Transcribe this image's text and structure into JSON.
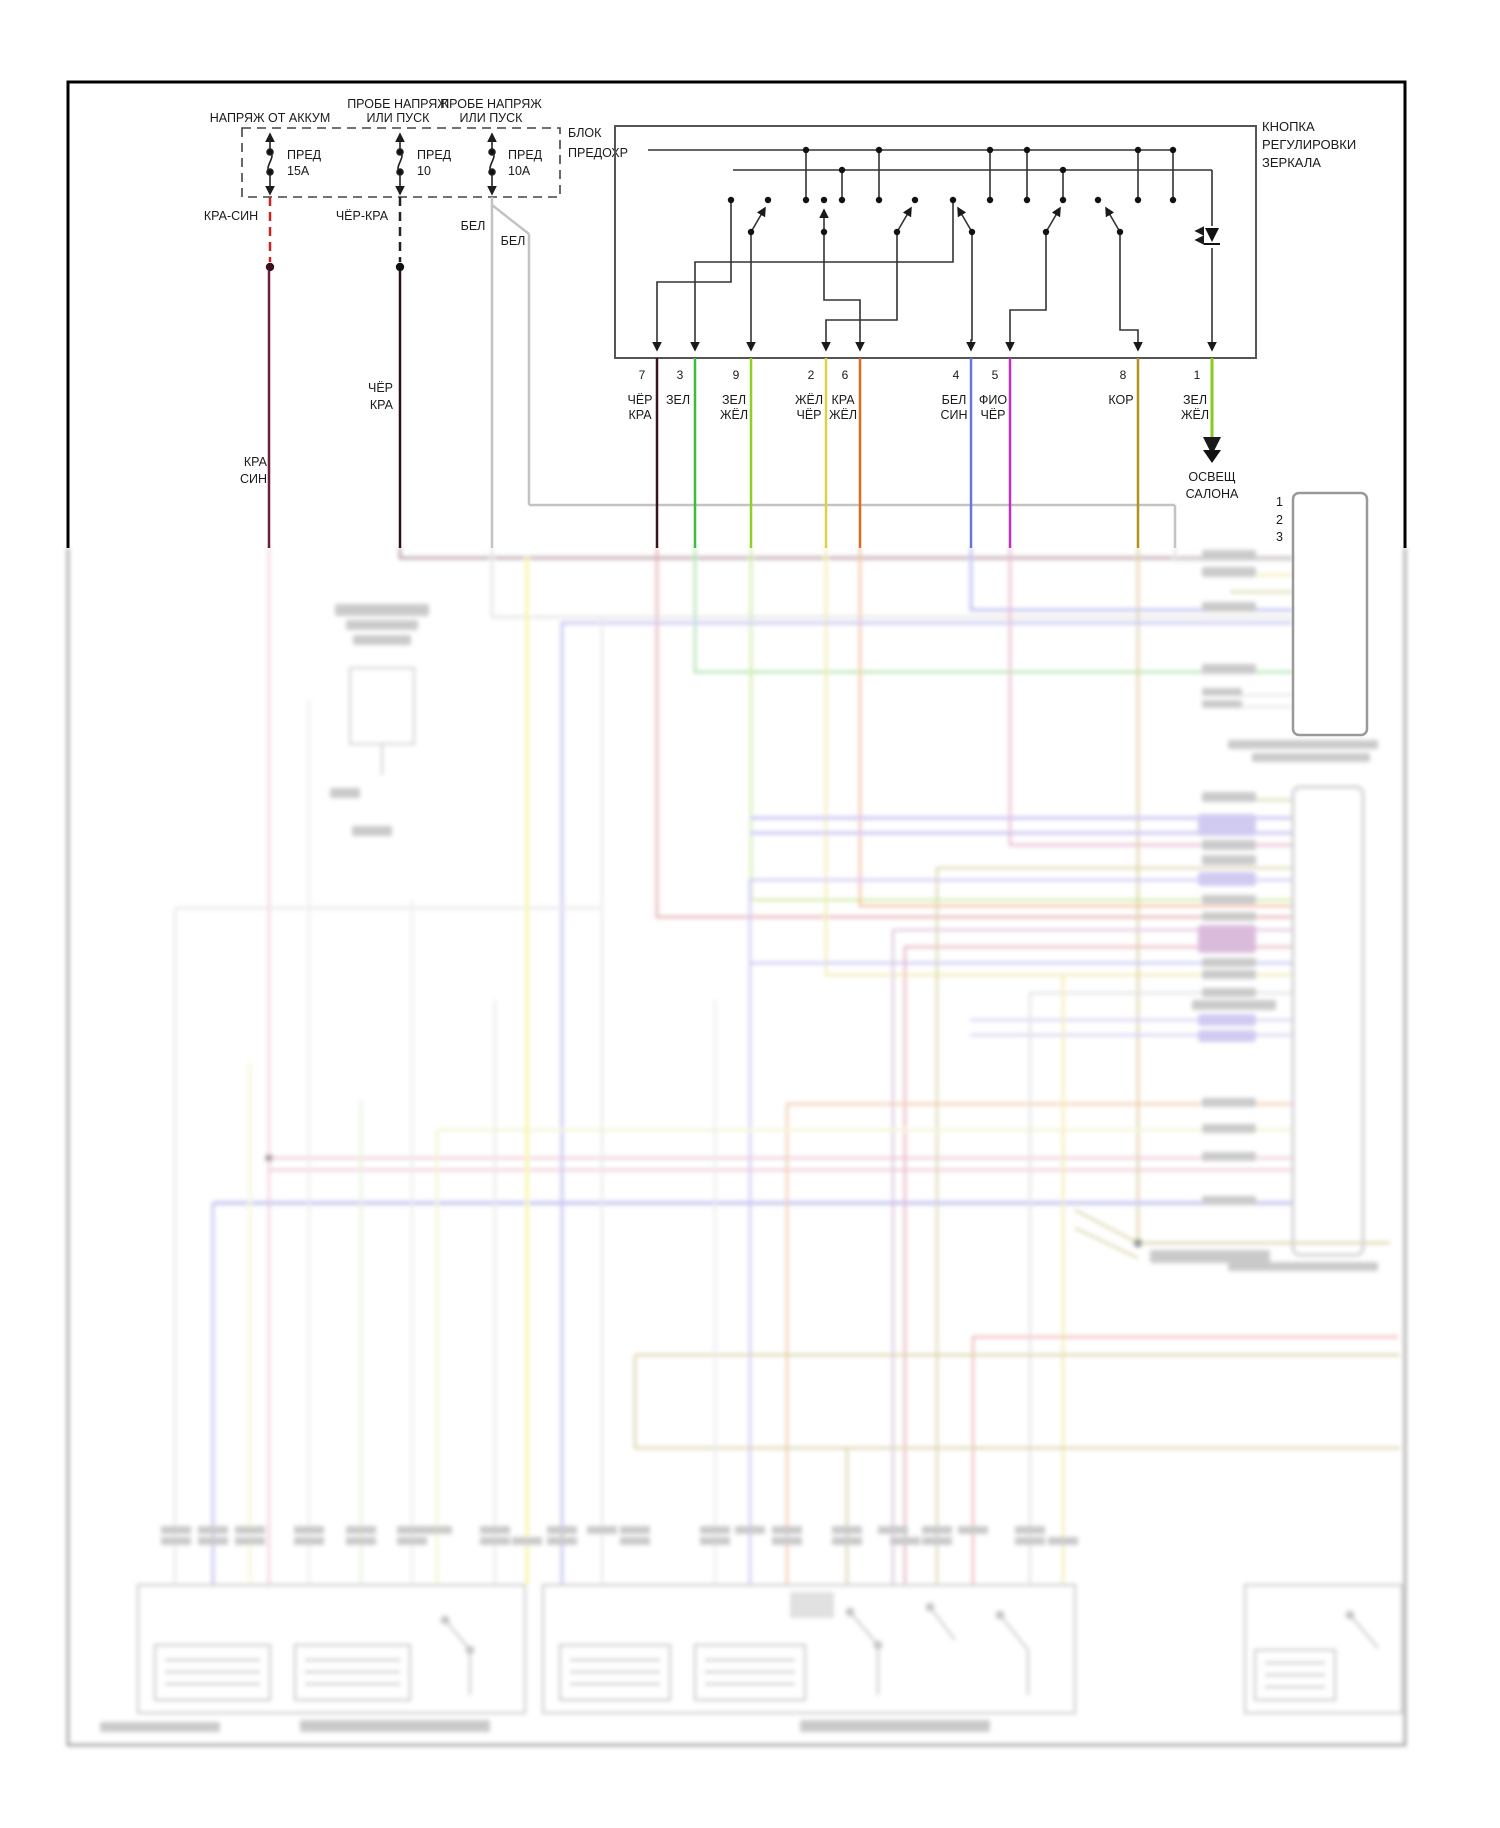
{
  "fuse_area": {
    "feed1": "НАПРЯЖ ОТ АККУМ",
    "feed2a": "ПРОБЕ НАПРЯЖ",
    "feed2b": "ИЛИ ПУСК",
    "feed3a": "ПРОБЕ НАПРЯЖ",
    "feed3b": "ИЛИ ПУСК",
    "block1": "БЛОК",
    "block2": "ПРЕДОХР",
    "fuses": [
      {
        "name": "ПРЕД",
        "amp": "15А"
      },
      {
        "name": "ПРЕД",
        "amp": "10"
      },
      {
        "name": "ПРЕД",
        "amp": "10А"
      }
    ]
  },
  "wire_labels": {
    "kra_sin": "КРА-СИН",
    "cher_kra": "ЧЁР-КРА",
    "bel1": "БЕЛ",
    "bel2": "БЕЛ",
    "cher2a": "ЧЁР",
    "cher2b": "КРА",
    "kra2a": "КРА",
    "kra2b": "СИН"
  },
  "switch_block": {
    "title1": "КНОПКА",
    "title2": "РЕГУЛИРОВКИ",
    "title3": "ЗЕРКАЛА"
  },
  "pins": [
    {
      "num": "7",
      "c0": "ЧЁР",
      "c1": "КРА"
    },
    {
      "num": "3",
      "c0": "ЗЕЛ",
      "c1": ""
    },
    {
      "num": "9",
      "c0": "ЗЕЛ",
      "c1": "ЖЁЛ"
    },
    {
      "num": "2",
      "c0": "ЖЁЛ",
      "c1": "ЧЁР"
    },
    {
      "num": "6",
      "c0": "КРА",
      "c1": "ЖЁЛ"
    },
    {
      "num": "4",
      "c0": "БЕЛ",
      "c1": "СИН"
    },
    {
      "num": "5",
      "c0": "ФИО",
      "c1": "ЧЁР"
    },
    {
      "num": "8",
      "c0": "КОР",
      "c1": ""
    },
    {
      "num": "1",
      "c0": "ЗЕЛ",
      "c1": "ЖЁЛ"
    }
  ],
  "cabin_light": {
    "l1": "ОСВЕЩ",
    "l2": "САЛОНА"
  },
  "connector": {
    "p1": "1",
    "p2": "2",
    "p3": "3"
  },
  "colors": {
    "kra_sin_wire": "#6a1f38",
    "cher_kra_wire": "#2e0f1e",
    "bel_wire": "#c6c2c2",
    "pin7": "#3b1220",
    "pin3": "#3dbb3d",
    "pin9": "#8ed026",
    "pin2": "#e3cf45",
    "pin6": "#e06820",
    "pin4": "#6677e0",
    "pin5": "#c030c0",
    "pin8": "#b3901f",
    "pin1": "#85cc1f",
    "dash_red": "#cc2222"
  }
}
